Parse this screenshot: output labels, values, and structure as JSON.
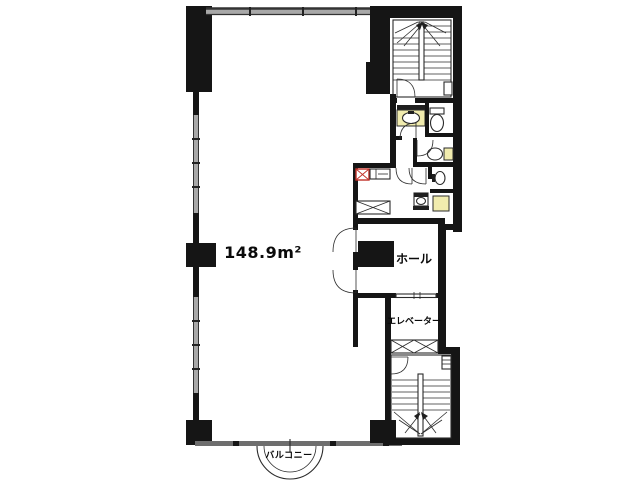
{
  "floor_plan": {
    "labels": {
      "area": "148.9m²",
      "hall": "ホール",
      "elevator": "エレベーター",
      "balcony": "バルコニー"
    },
    "colors": {
      "wall": "#151515",
      "line": "#2b2b2b",
      "window": "#a8a8a8",
      "window_dark": "#6e6e6e",
      "fixture": "#f1ecae",
      "accent_red": "#c03028",
      "background": "#ffffff"
    }
  }
}
